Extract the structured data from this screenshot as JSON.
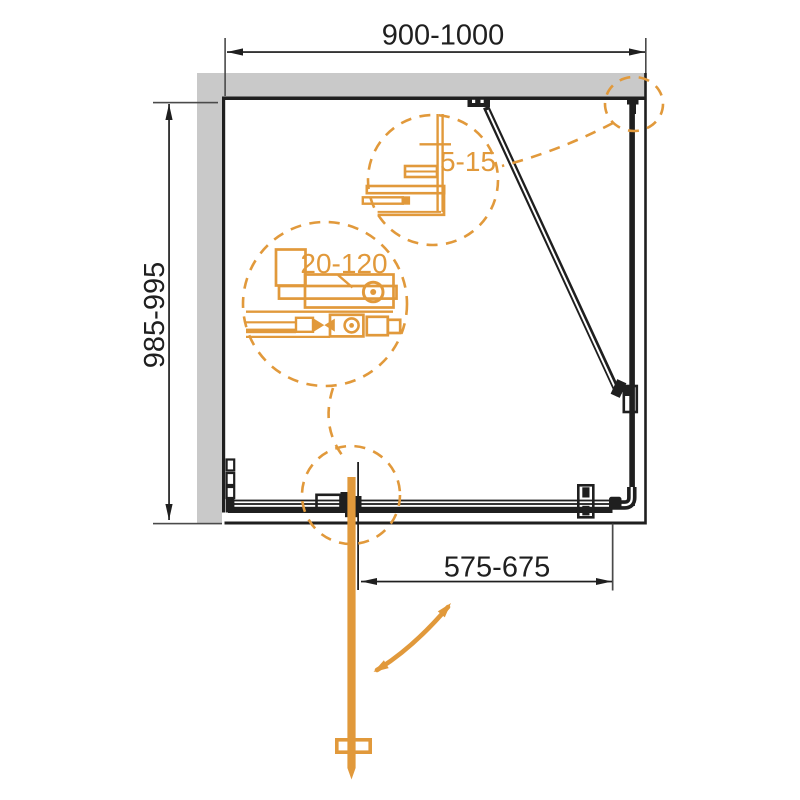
{
  "colors": {
    "orange": "#E1993B",
    "wall_gray": "#C9C9C9",
    "line": "#1F1F1F",
    "dim_gray": "#4A4A4A"
  },
  "dimensions": {
    "overall_width": "900-1000",
    "side_depth": "985-995",
    "door_width": "575-675",
    "detail_wall_profile": "5-15",
    "detail_mechanism": "20-120"
  }
}
